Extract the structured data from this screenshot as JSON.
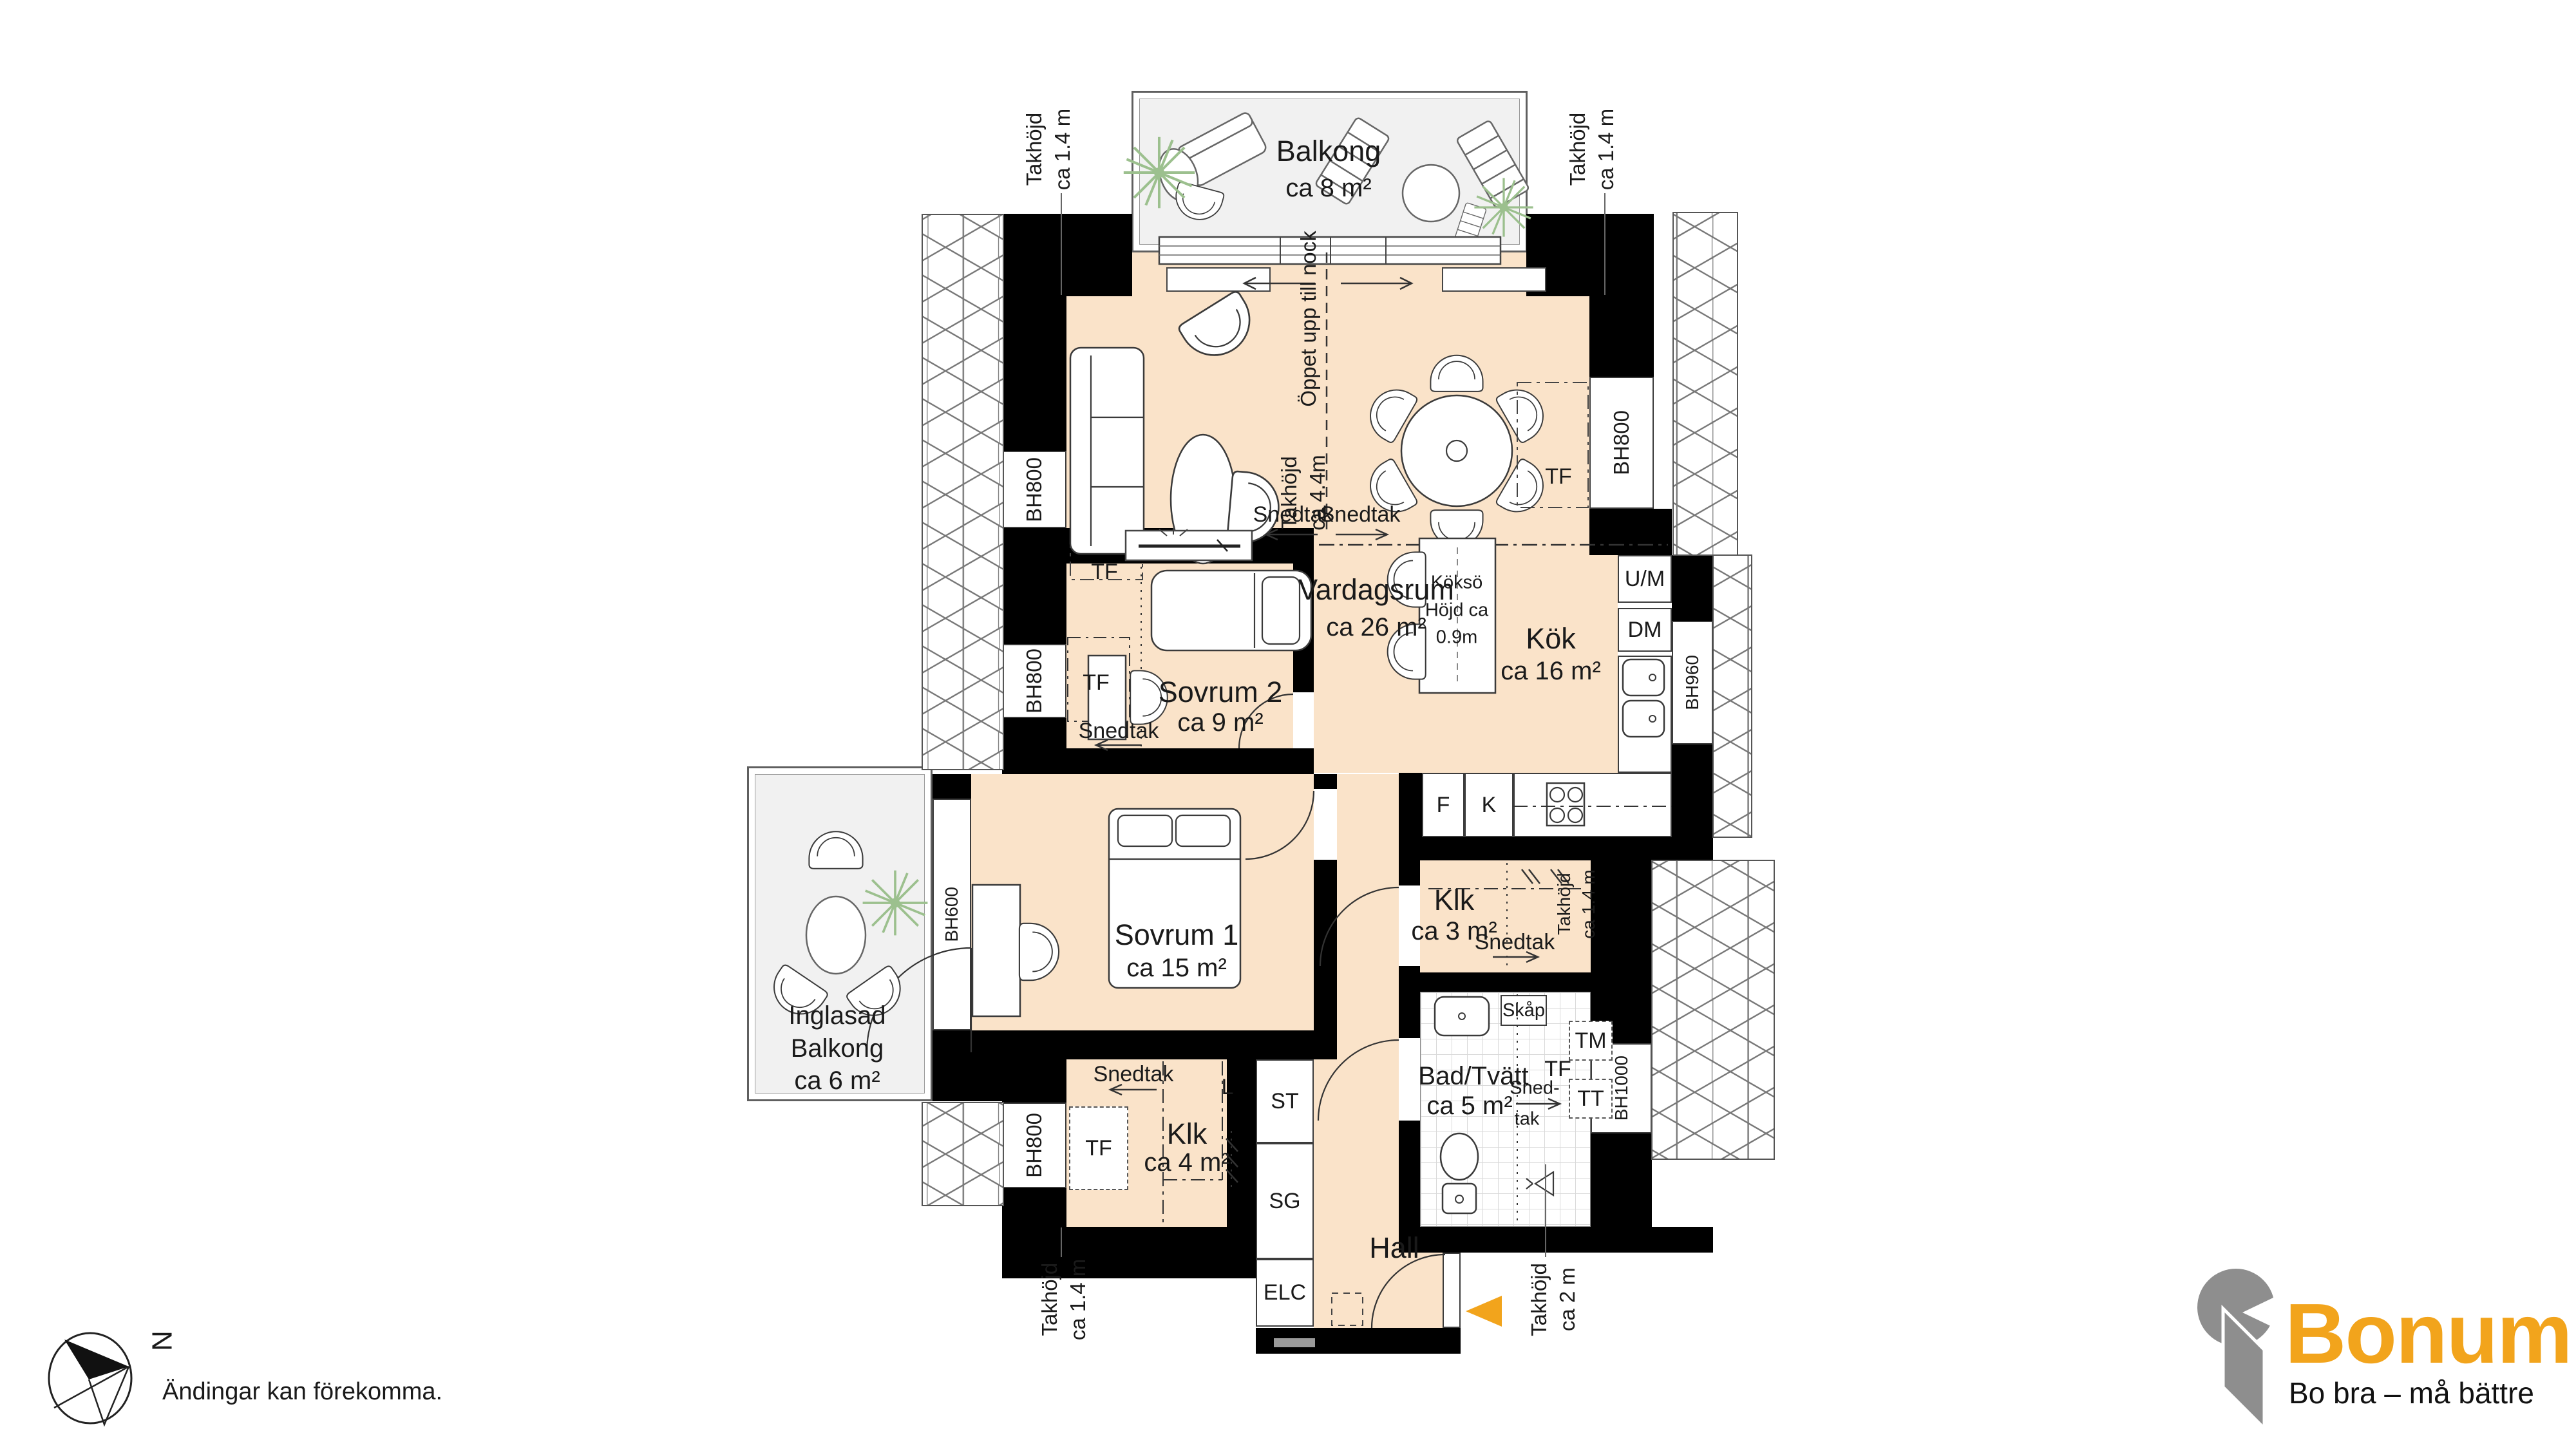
{
  "colors": {
    "floor": "#FAE3C9",
    "wall": "#000000",
    "accent_orange": "#F2A41C",
    "logo_gray": "#8E8E8E",
    "balcony_fill": "#F1F1F1",
    "plant_green": "#9CC08E"
  },
  "rooms": {
    "balkong": {
      "name": "Balkong",
      "area": "ca 8 m²"
    },
    "vardagsrum": {
      "name": "Vardagsrum",
      "area": "ca 26 m²"
    },
    "kok": {
      "name": "Kök",
      "area": "ca 16 m²"
    },
    "sovrum2": {
      "name": "Sovrum 2",
      "area": "ca 9 m²"
    },
    "sovrum1": {
      "name": "Sovrum 1",
      "area": "ca 15 m²"
    },
    "inglasad_balkong": {
      "name_line1": "Inglasad",
      "name_line2": "Balkong",
      "area": "ca 6 m²"
    },
    "klk_3": {
      "name": "Klk",
      "area": "ca 3 m²"
    },
    "klk_4": {
      "name": "Klk",
      "area": "ca 4 m²"
    },
    "bad_tvatt": {
      "name": "Bad/Tvätt",
      "area": "ca 5 m²"
    },
    "hall": {
      "name": "Hall"
    }
  },
  "island": {
    "line1": "Köksö",
    "line2": "Höjd ca",
    "line3": "0.9m"
  },
  "windows": {
    "bh800": "BH800",
    "bh600": "BH600",
    "bh960": "BH960",
    "bh1000": "BH1000"
  },
  "fixtures": {
    "tf": "TF",
    "um": "U/M",
    "dm": "DM",
    "f": "F",
    "k": "K",
    "tm": "TM",
    "tt": "TT",
    "skap": "Skåp",
    "l": "L",
    "st": "ST",
    "sg": "SG",
    "elc": "ELC"
  },
  "ceiling": {
    "open": "Öppet upp till nock",
    "h44_1": "Takhöjd",
    "h44_2": "ca 4.4m",
    "h14_1": "Takhöjd",
    "h14_2": "ca 1.4 m",
    "h2_1": "Takhöjd",
    "h2_2": "ca 2 m",
    "snedtak": "Snedtak",
    "snedtak_hy1": "Sned-",
    "snedtak_hy2": "tak"
  },
  "compass": {
    "north": "N"
  },
  "footer": {
    "disclaimer": "Ändingar kan förekomma."
  },
  "brand": {
    "name": "Bonum",
    "tagline": "Bo bra – må bättre"
  }
}
